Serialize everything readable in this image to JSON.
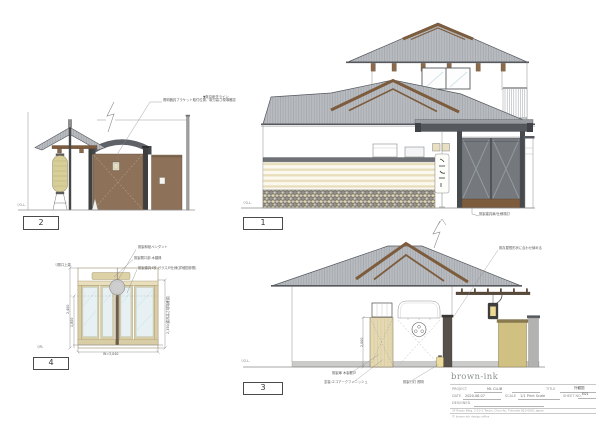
{
  "sheet": {
    "background": "#ffffff"
  },
  "common": {
    "gl_label": "▽G.L."
  },
  "colors": {
    "roof_gray": "#b8bcc0",
    "gable_brown": "#7d5c3e",
    "beam_dark": "#55595d",
    "wall_brown": "#8d7158",
    "wood_tan": "#e4d9b2",
    "lantern_tan": "#d8ce98",
    "stripe_cream": "#e8debb",
    "stone_yellow": "#e2dbad",
    "fence_tan": "#d6c686"
  },
  "drawings": {
    "d1": {
      "number": "1",
      "note_left": "▼既存軒先ライン",
      "note_gate": "既製建具扉/仕様検討"
    },
    "d2": {
      "number": "2",
      "note_bracket": "照明器具ブラケット取付位置、取付高さ現場確認"
    },
    "d3": {
      "number": "3",
      "note_roof": "既存屋根形状に合わせ納める",
      "note_door": "既製扉 木製框戸",
      "note_paint": "塗装:エコアークフィニッシュ",
      "note_lantern": "既製行灯 照明",
      "dim_left": "2,000"
    },
    "d4": {
      "number": "4",
      "note_pendant": "既製和紙ペンダント",
      "note_board": "既製開口部 木額縁",
      "note_doors": "既製建具4枚 ガラス戸仕様(詳細図参照)",
      "top_label": "▽開口上端",
      "fl_label": "▽FL",
      "dim_outer": "2,400",
      "dim_inner": "1,800",
      "dim_right": "2,350(建具高さ現場確認)",
      "dim_width": "W=3,040"
    }
  },
  "titleblock": {
    "logo": "brown-ink",
    "project_label": "PROJECT",
    "project_value": "ML CLUB",
    "title_label": "TITLE",
    "title_value": "外観図",
    "date_label": "DATE",
    "date_value": "2020.06.07",
    "scale_label": "SCALE",
    "scale_value": "1/1 Print Scale",
    "sheet_label": "SHEET NO.",
    "sheet_value": "E01",
    "designed_label": "DESIGNED",
    "address": "3F Rosso Bldg. 2-10-1 Tenjin, Chuo-ku, Fukuoka 810-0001 Japan",
    "copyright": "© brown-ink design office"
  }
}
